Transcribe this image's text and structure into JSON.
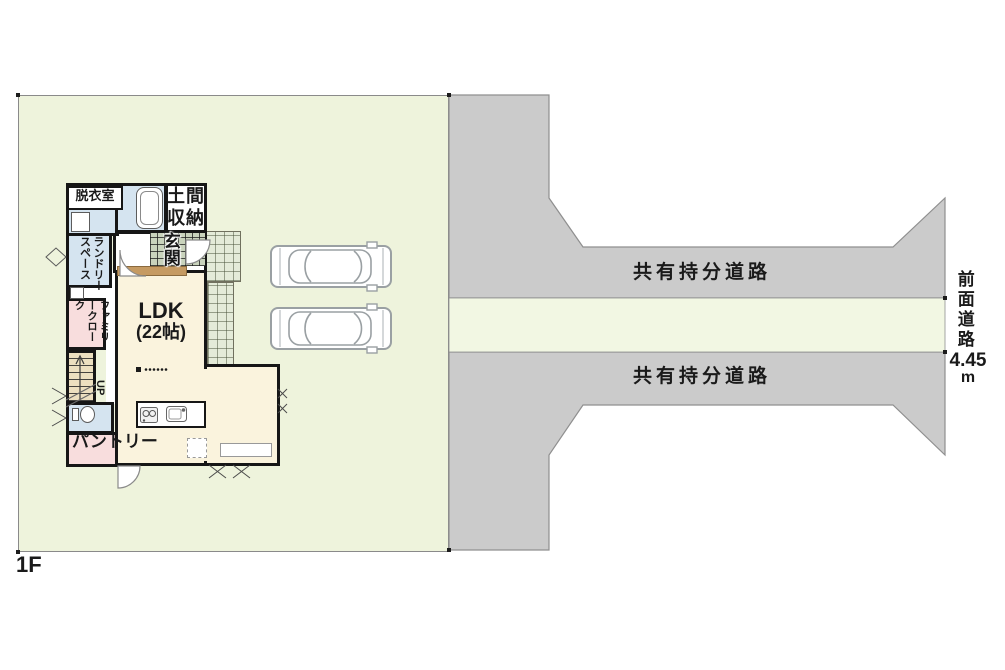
{
  "page": {
    "floor_label": "1F"
  },
  "site": {
    "shared_road_top_label": "共有持分道路",
    "shared_road_bottom_label": "共有持分道路",
    "front_road_label": "前面道路",
    "front_road_width_value": "4.45",
    "front_road_width_unit": "m",
    "vehicle_icon": "car-icon"
  },
  "floor_plan": {
    "rooms": {
      "dressing_room": "脱衣室",
      "laundry_space": "ランドリースペース",
      "doma_storage": "土間収納",
      "entrance": "玄関",
      "ldk_name": "LDK",
      "ldk_size": "(22帖)",
      "family_closet": "ファミリークローク",
      "stairs_direction": "UP",
      "pantry": "パントリー"
    }
  },
  "colors": {
    "plot_green": "#eef3dc",
    "front_road_green": "#f2f7e3",
    "road_gray": "#cbcbcb",
    "road_border": "#8f8f8f",
    "wall_black": "#161616",
    "floor_cream": "#faf3dd",
    "wet_area_blue": "#d5e4f0",
    "closet_pink": "#f8dddd",
    "stairs_tan": "#ecdfc0",
    "tile_green": "#e4ebd8",
    "genkan_tile": "#c9d3bc",
    "step_brown": "#c59a62"
  }
}
